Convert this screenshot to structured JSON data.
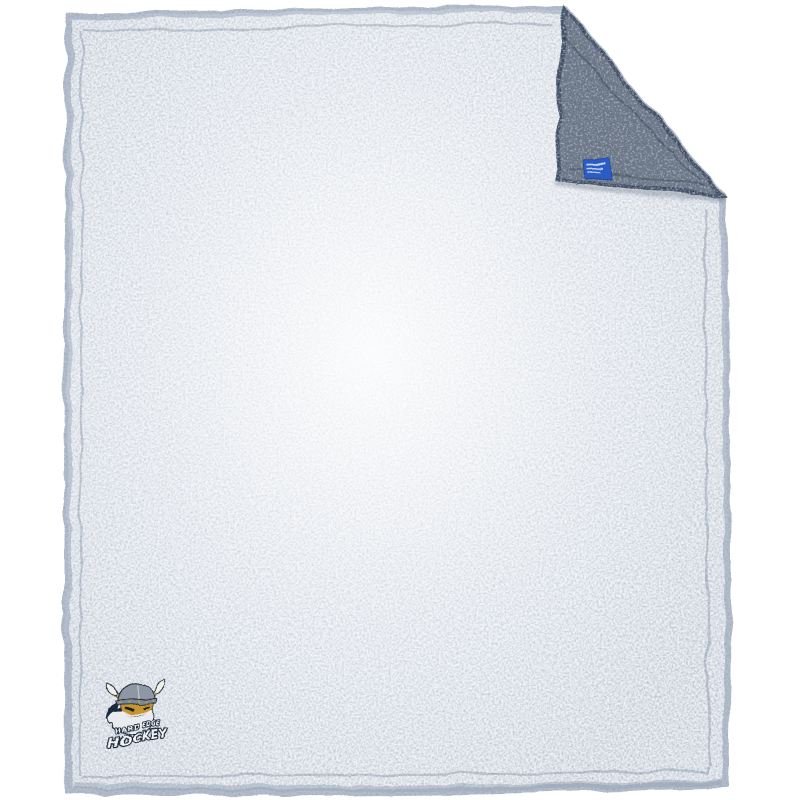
{
  "canvas": {
    "width": 800,
    "height": 800,
    "background_color": "#ffffff"
  },
  "blanket": {
    "alt": "Frosted grey sherpa fleece blanket with top-right corner folded over showing darker reverse side",
    "front": {
      "base_color": "#edf0f4",
      "speckle_color": "#455977",
      "edge_fluff_color": "#b7c0cd",
      "seam_color": "#54657f"
    },
    "back": {
      "base_color": "#747e8c",
      "speckle_color": "#1c2933"
    },
    "brand_tag": {
      "color": "#2a5bc4",
      "stitch_color": "#d9e4f6"
    },
    "logo": {
      "line1": "HARD EDGE",
      "line2": "HOCKEY",
      "colors": {
        "outline": "#1f2b3a",
        "helmet": "#8e97a3",
        "helmet_band": "#7b8694",
        "horns": "#f1efe8",
        "gold": "#c9a23f",
        "face": "#c6952f",
        "beard": "#e9ebee",
        "text_fill": "#f2f4f6"
      }
    }
  }
}
